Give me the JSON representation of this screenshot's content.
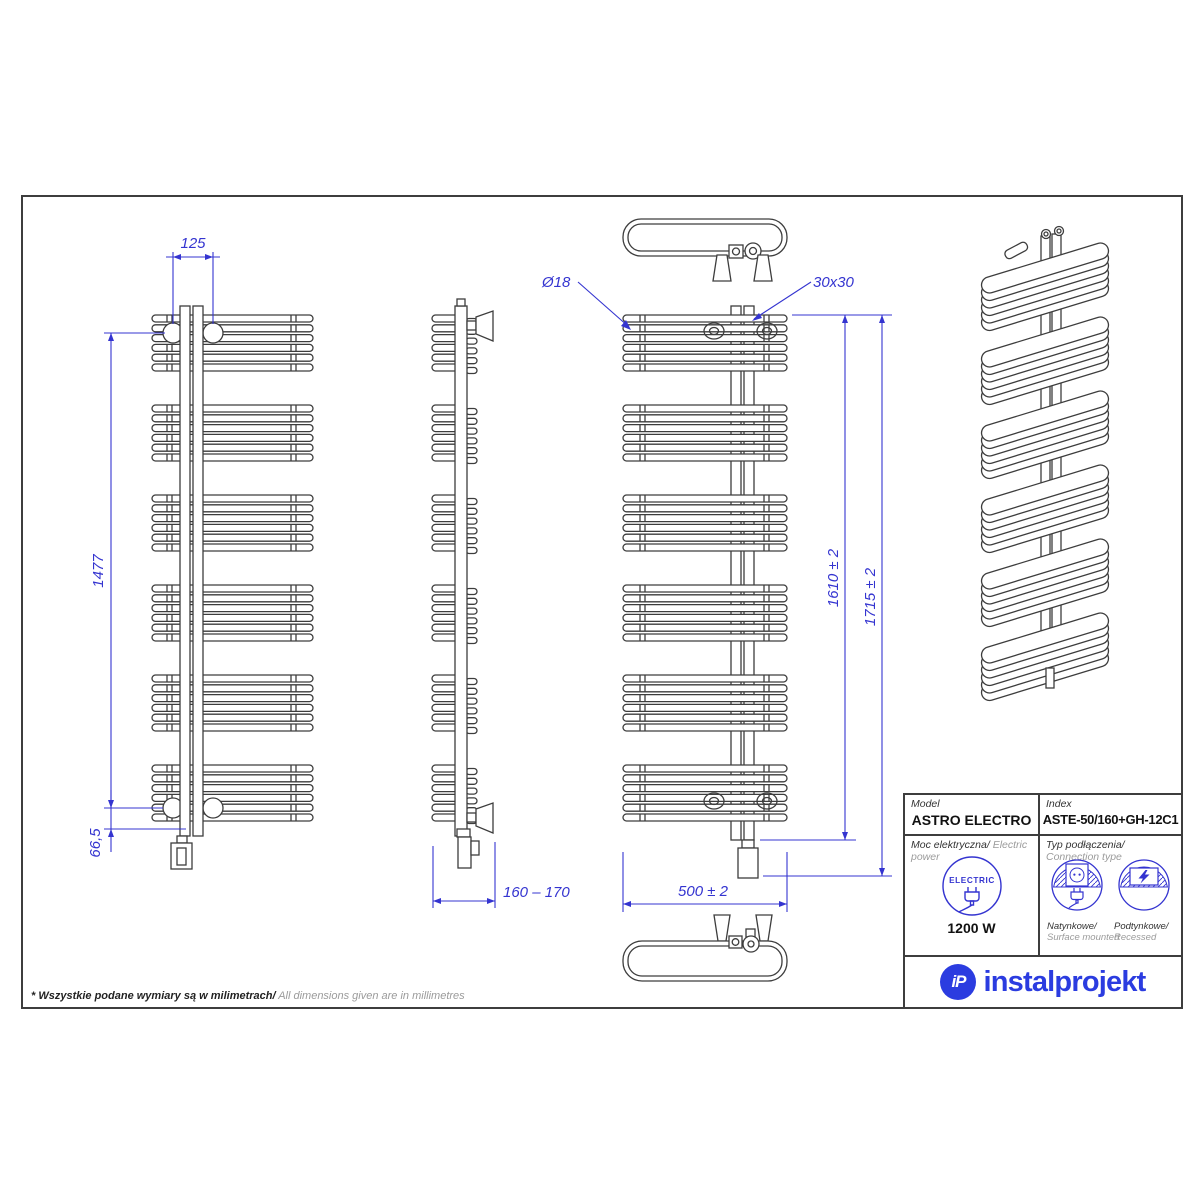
{
  "note": {
    "pl": "* Wszystkie podane wymiary są w milimetrach/",
    "en": " All dimensions given are in millimetres"
  },
  "title_block": {
    "model_label": "Model",
    "model_value": "ASTRO ELECTRO",
    "index_label": "Index",
    "index_value": "ASTE-50/160+GH-12C1",
    "power_label_pl": "Moc elektryczna/",
    "power_label_en": " Electric power",
    "power_icon_text": "ELECTRIC",
    "power_value": "1200 W",
    "connection_label_pl": "Typ podłączenia/",
    "connection_label_en": "Connection type",
    "surface_pl": "Natynkowe/",
    "surface_en": "Surface mounted",
    "recessed_pl": "Podtynkowe/",
    "recessed_en": "Recessed",
    "brand": "instalprojekt",
    "brand_mark": "iP"
  },
  "dimensions": {
    "top_spacing": "125",
    "mounting_height": "1477",
    "bottom_offset": "66,5",
    "depth_range": "160 – 170",
    "tube_diameter": "Ø18",
    "collector_profile": "30x30",
    "body_height": "1610 ± 2",
    "total_height": "1715 ± 2",
    "width": "500 ± 2"
  },
  "drawing": {
    "tube_groups": 6,
    "tubes_per_group": 6
  },
  "colors": {
    "dimension": "#3434d0",
    "line": "#3d3d3d",
    "brand": "#2b3ce0"
  }
}
